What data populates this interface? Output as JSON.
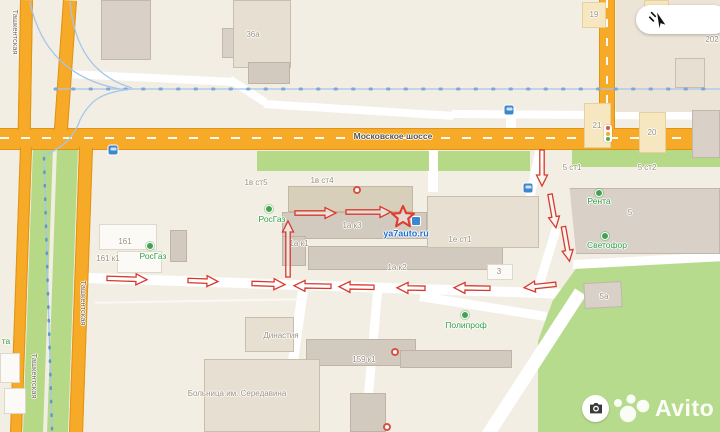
{
  "colors": {
    "road_orange": "#f7a928",
    "route_red": "#d8392e",
    "poi_green": "#2f9e44",
    "link_blue": "#1f6ecc",
    "park_green": "#b7db8d",
    "transit_blue": "#8fb9e6",
    "building_tan": "#f7e7c0"
  },
  "map": {
    "road_labels": [
      {
        "text": "Московское шоссе",
        "x": 393,
        "y": 136
      }
    ],
    "street_labels_vertical": [
      {
        "text": "Ташкентская",
        "x": 15,
        "y": 32
      },
      {
        "text": "Ташкентская",
        "x": 83,
        "y": 303
      },
      {
        "text": "Ташкентская",
        "x": 34,
        "y": 376
      }
    ],
    "building_labels": [
      {
        "text": "36а",
        "x": 253,
        "y": 35
      },
      {
        "text": "19",
        "x": 594,
        "y": 15
      },
      {
        "text": "18",
        "x": 656,
        "y": 13
      },
      {
        "text": "21",
        "x": 597,
        "y": 126
      },
      {
        "text": "20",
        "x": 652,
        "y": 133
      },
      {
        "text": "202",
        "x": 712,
        "y": 40
      },
      {
        "text": "1в ст5",
        "x": 256,
        "y": 183
      },
      {
        "text": "1в ст4",
        "x": 322,
        "y": 181
      },
      {
        "text": "5 ст1",
        "x": 572,
        "y": 168
      },
      {
        "text": "5 ст2",
        "x": 647,
        "y": 168
      },
      {
        "text": "1а к3",
        "x": 352,
        "y": 226
      },
      {
        "text": "1а к1",
        "x": 299,
        "y": 244
      },
      {
        "text": "1а к2",
        "x": 397,
        "y": 268
      },
      {
        "text": "1е ст1",
        "x": 460,
        "y": 240
      },
      {
        "text": "161",
        "x": 125,
        "y": 242
      },
      {
        "text": "161 к1",
        "x": 108,
        "y": 259
      },
      {
        "text": "5",
        "x": 630,
        "y": 213
      },
      {
        "text": "5а",
        "x": 604,
        "y": 297
      },
      {
        "text": "3",
        "x": 499,
        "y": 272
      },
      {
        "text": "159 к1",
        "x": 364,
        "y": 360
      },
      {
        "text": "Династия",
        "x": 281,
        "y": 336
      },
      {
        "text": "Больница им. Середавина",
        "x": 237,
        "y": 394
      }
    ],
    "poi_labels": [
      {
        "text": "РосГаз",
        "x": 153,
        "y": 256,
        "px": 150,
        "py": 246
      },
      {
        "text": "РосГаз",
        "x": 272,
        "y": 219,
        "px": 269,
        "py": 209
      },
      {
        "text": "Рента",
        "x": 599,
        "y": 201,
        "px": 599,
        "py": 193
      },
      {
        "text": "Светофор",
        "x": 607,
        "y": 245,
        "px": 605,
        "py": 236
      },
      {
        "text": "Полипроф",
        "x": 466,
        "y": 325,
        "px": 465,
        "py": 315
      },
      {
        "text": "та",
        "x": 6,
        "y": 341
      }
    ],
    "org_link": {
      "text": "ya7auto.ru",
      "x": 406,
      "y": 234
    },
    "star": {
      "x": 403,
      "y": 217
    },
    "route_arrows": [
      {
        "a": 2,
        "x": 127,
        "y": 279,
        "l": 40
      },
      {
        "a": 2,
        "x": 203,
        "y": 281,
        "l": 30
      },
      {
        "a": 2,
        "x": 268,
        "y": 284,
        "l": 33
      },
      {
        "a": 181,
        "x": 312,
        "y": 286,
        "l": 37
      },
      {
        "a": 181,
        "x": 356,
        "y": 287,
        "l": 35
      },
      {
        "a": 181,
        "x": 411,
        "y": 288,
        "l": 28
      },
      {
        "a": 181,
        "x": 472,
        "y": 288,
        "l": 36
      },
      {
        "a": 174,
        "x": 540,
        "y": 286,
        "l": 32
      },
      {
        "a": 0,
        "x": 315,
        "y": 213,
        "l": 41
      },
      {
        "a": 0,
        "x": 368,
        "y": 212,
        "l": 45
      },
      {
        "a": 270,
        "x": 288,
        "y": 249,
        "l": 56
      },
      {
        "a": 90,
        "x": 542,
        "y": 168,
        "l": 36
      },
      {
        "a": 80,
        "x": 553,
        "y": 211,
        "l": 34
      },
      {
        "a": 80,
        "x": 566,
        "y": 244,
        "l": 35
      }
    ],
    "transit_stops": [
      {
        "x": 113,
        "y": 150
      },
      {
        "x": 509,
        "y": 110
      },
      {
        "x": 528,
        "y": 188
      }
    ],
    "org_pins_red": [
      {
        "x": 357,
        "y": 190
      },
      {
        "x": 395,
        "y": 352
      },
      {
        "x": 387,
        "y": 427
      }
    ]
  },
  "controls": {
    "cursor_button_icon": "drag-cursor-icon"
  },
  "watermark": {
    "brand": "Avito",
    "camera_icon": "camera-icon"
  }
}
